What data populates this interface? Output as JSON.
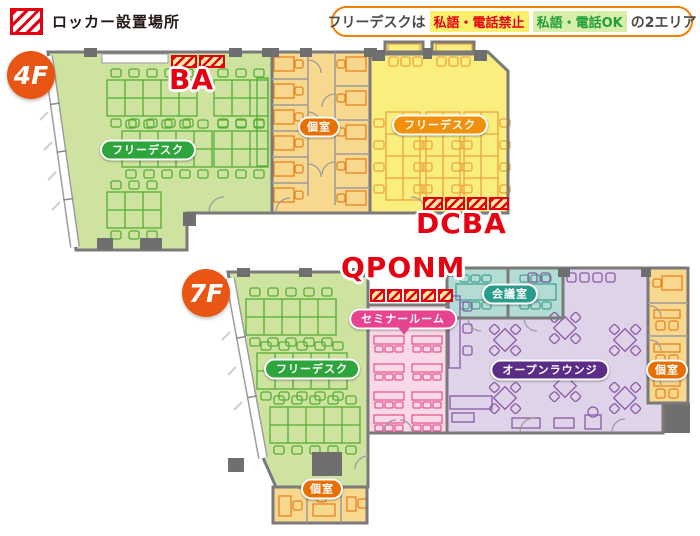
{
  "legend": {
    "label": "ロッカー設置場所",
    "swatch_icon": "locker-hatch-icon"
  },
  "banner": {
    "prefix": "フリーデスクは",
    "no_talk": "私語・電話禁止",
    "talk_ok": "私語・電話OK",
    "suffix": "の2エリア"
  },
  "floors": {
    "f4": {
      "badge": "4F",
      "labels": {
        "free_desk_green": "フリーデスク",
        "private_rooms": "個室",
        "free_desk_yellow": "フリーデスク"
      },
      "lockers": {
        "top": "BA",
        "bottom": "DCBA"
      },
      "locker_segments": {
        "top": 2,
        "bottom": 4
      }
    },
    "f7": {
      "badge": "7F",
      "labels": {
        "free_desk": "フリーデスク",
        "seminar": "セミナールーム",
        "meeting": "会議室",
        "lounge": "オープンラウンジ",
        "private_right": "個室",
        "private_bottom": "個室"
      },
      "lockers": {
        "top": "QPONM"
      },
      "locker_segments": {
        "top": 5
      }
    }
  },
  "colors": {
    "locker_red": "#e60012",
    "locker_hatch_bg": "#f7e9a0",
    "floor_green": "#cfe3a0",
    "floor_orange": "#f8d78f",
    "floor_yellow": "#f9ee7e",
    "floor_pink": "#f9d9e6",
    "floor_teal": "#b2dcd4",
    "floor_purple": "#dfd3ea",
    "wall_gray": "#7a7a7a",
    "badge_orange": "#e95513",
    "pill_green": "#2ea43c",
    "pill_orange": "#e86f00",
    "pill_pink": "#e8438e",
    "pill_teal": "#2a9c8b",
    "pill_purple": "#5b2d86",
    "banner_border": "#ef8200",
    "no_talk_bg": "#fbf06b",
    "no_talk_text": "#e60012",
    "talk_ok_bg": "#d9edaa",
    "talk_ok_text": "#1f9f3a"
  }
}
